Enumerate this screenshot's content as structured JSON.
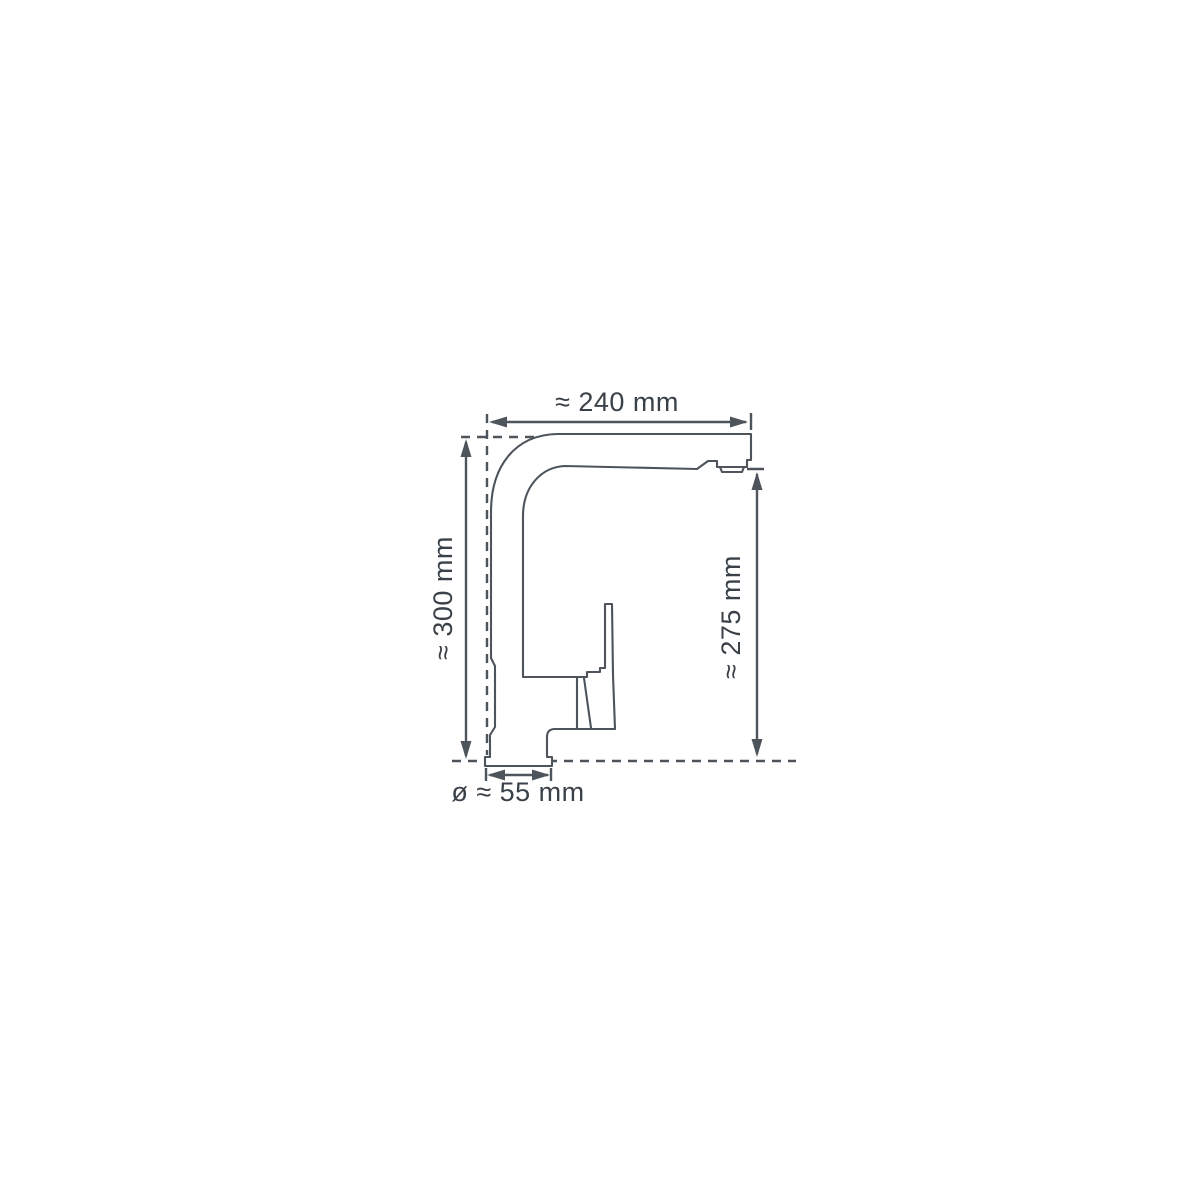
{
  "diagram": {
    "kind": "technical-dimension-drawing",
    "labels": {
      "spout_reach": "≈ 240 mm",
      "total_height": "≈ 300 mm",
      "outlet_height": "≈ 275 mm",
      "base_diameter": "ø ≈ 55 mm"
    },
    "colors": {
      "line": "#4d545b",
      "text": "#3a4148",
      "background": "#ffffff"
    }
  }
}
